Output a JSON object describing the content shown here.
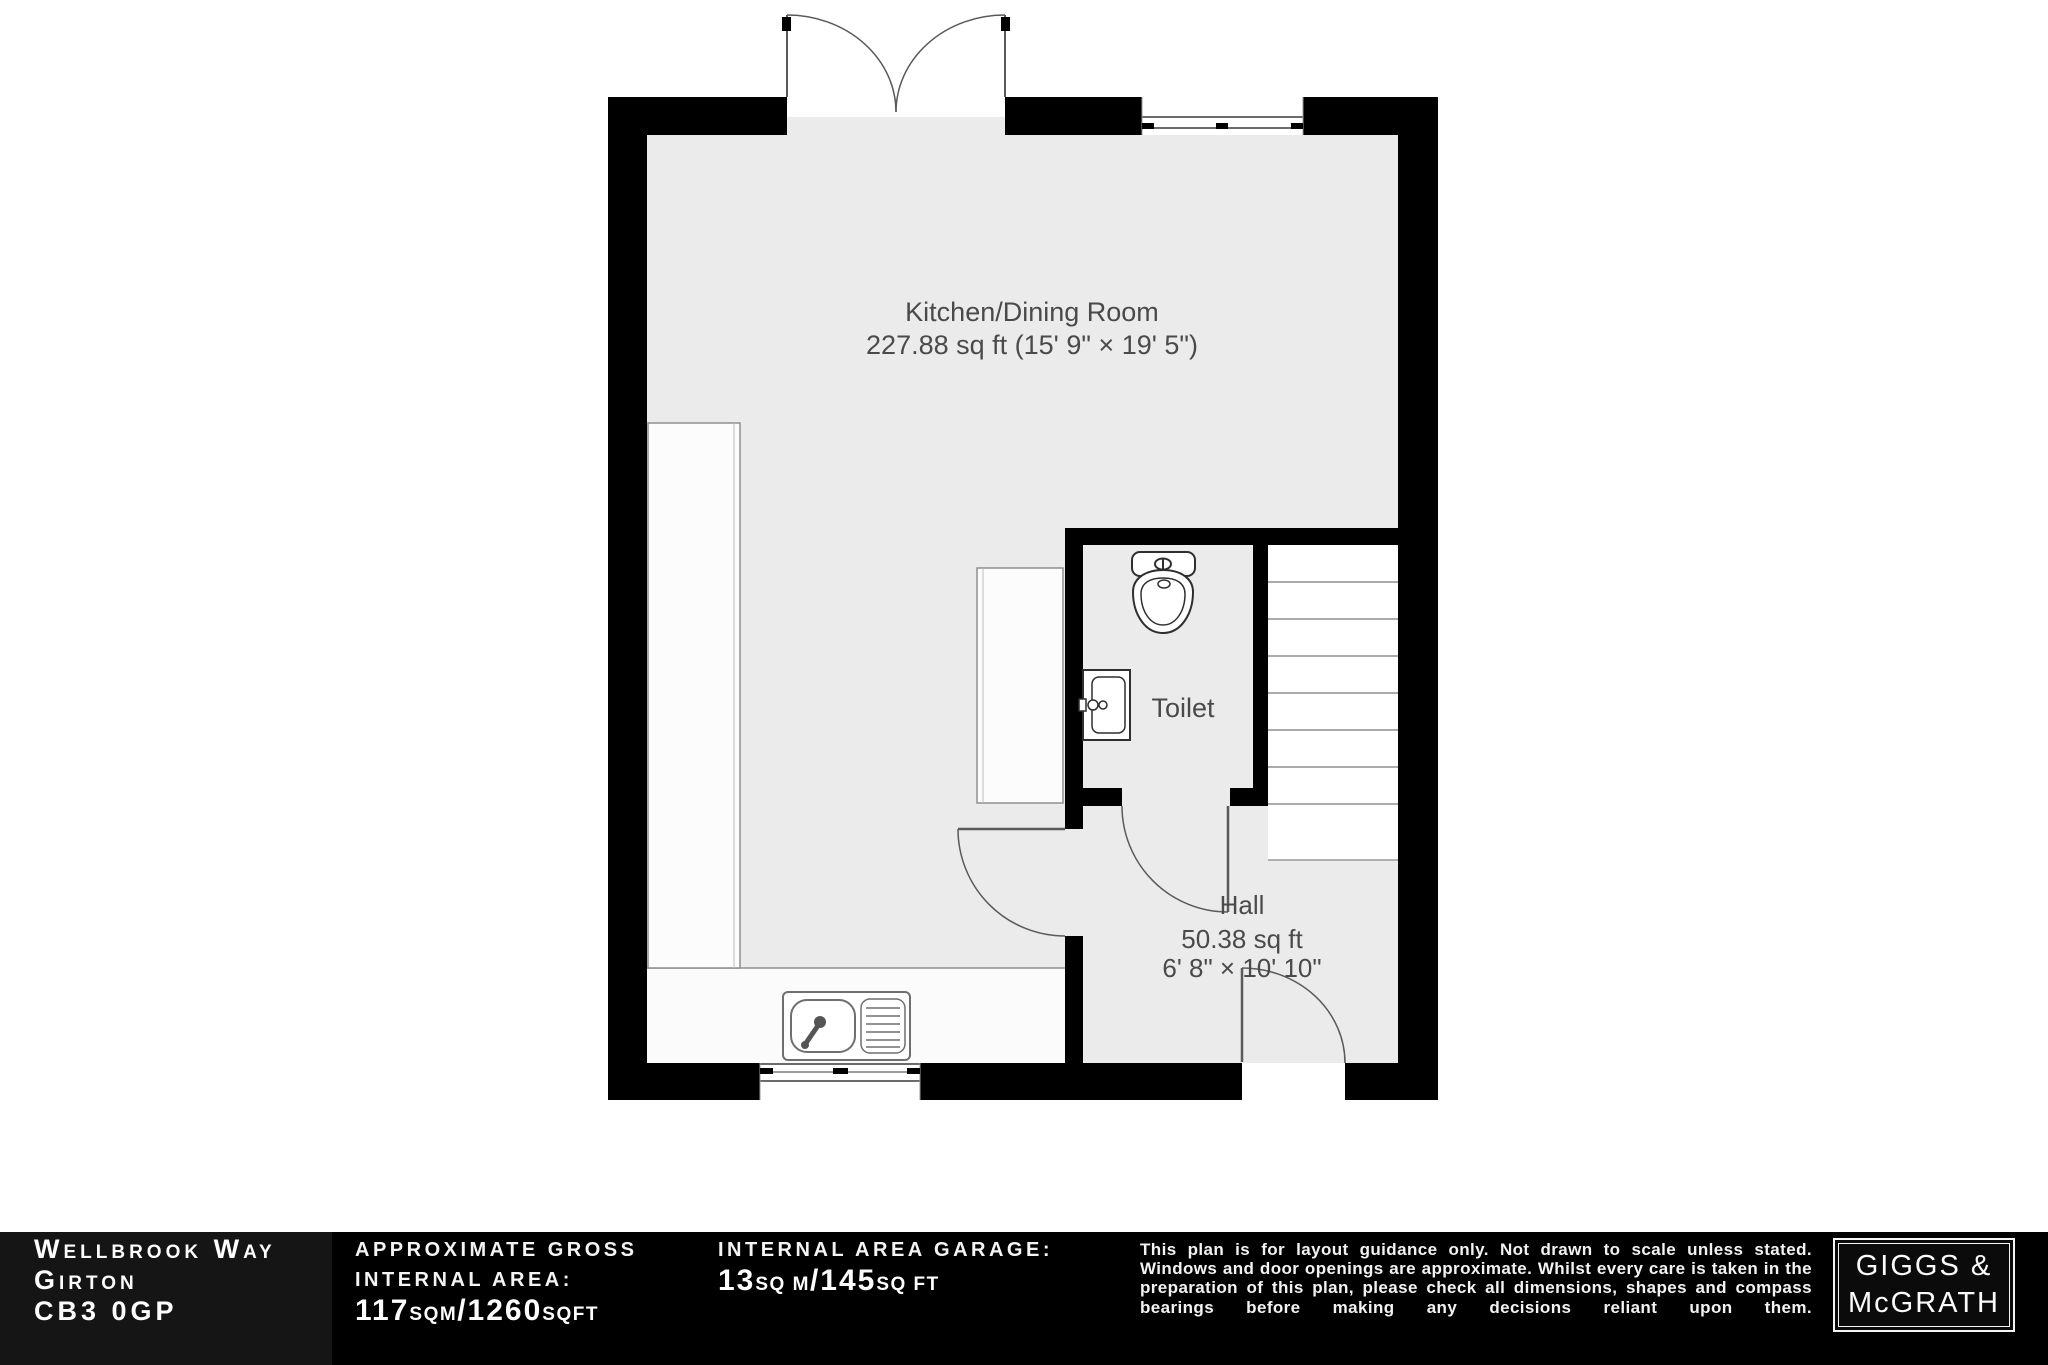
{
  "plan": {
    "rooms": {
      "kitchen": {
        "name": "Kitchen/Dining Room",
        "dims": "227.88 sq ft (15' 9\" × 19' 5\")"
      },
      "toilet": {
        "name": "Toilet"
      },
      "hall": {
        "name": "Hall",
        "area": "50.38 sq ft",
        "dims": "6' 8\" × 10' 10\""
      }
    },
    "icons": [
      "french-door-icon",
      "window-icon",
      "staircase-icon",
      "toilet-icon",
      "basin-icon",
      "sink-icon",
      "door-swing-icon"
    ]
  },
  "footer": {
    "address": {
      "line1": "Wellbrook Way",
      "line2": "Girton",
      "line3": "CB3 0GP"
    },
    "internal_area": {
      "label_line1": "APPROXIMATE GROSS",
      "label_line2": "INTERNAL AREA:",
      "num1": "117",
      "unit1": "SQM",
      "num2": "/1260",
      "unit2": "SQFT"
    },
    "garage_area": {
      "label": "INTERNAL AREA GARAGE:",
      "num1": "13",
      "unit1": "SQ M",
      "num2": "/145",
      "unit2": "SQ FT"
    },
    "disclaimer": "This plan is for layout guidance only. Not drawn to scale unless stated. Windows and door openings are approximate. Whilst every care is taken in the preparation of this plan, please check all dimensions, shapes and compass bearings before making any decisions reliant upon them.",
    "logo": {
      "line1": "GIGGS &",
      "line2": "McGRATH"
    }
  },
  "colors": {
    "floor": "#ebebeb",
    "wall": "#000000",
    "fixture_line": "#8f8f8f",
    "label": "#4a4a4a",
    "footer_bg": "#000000",
    "footer_text": "#ffffff"
  }
}
